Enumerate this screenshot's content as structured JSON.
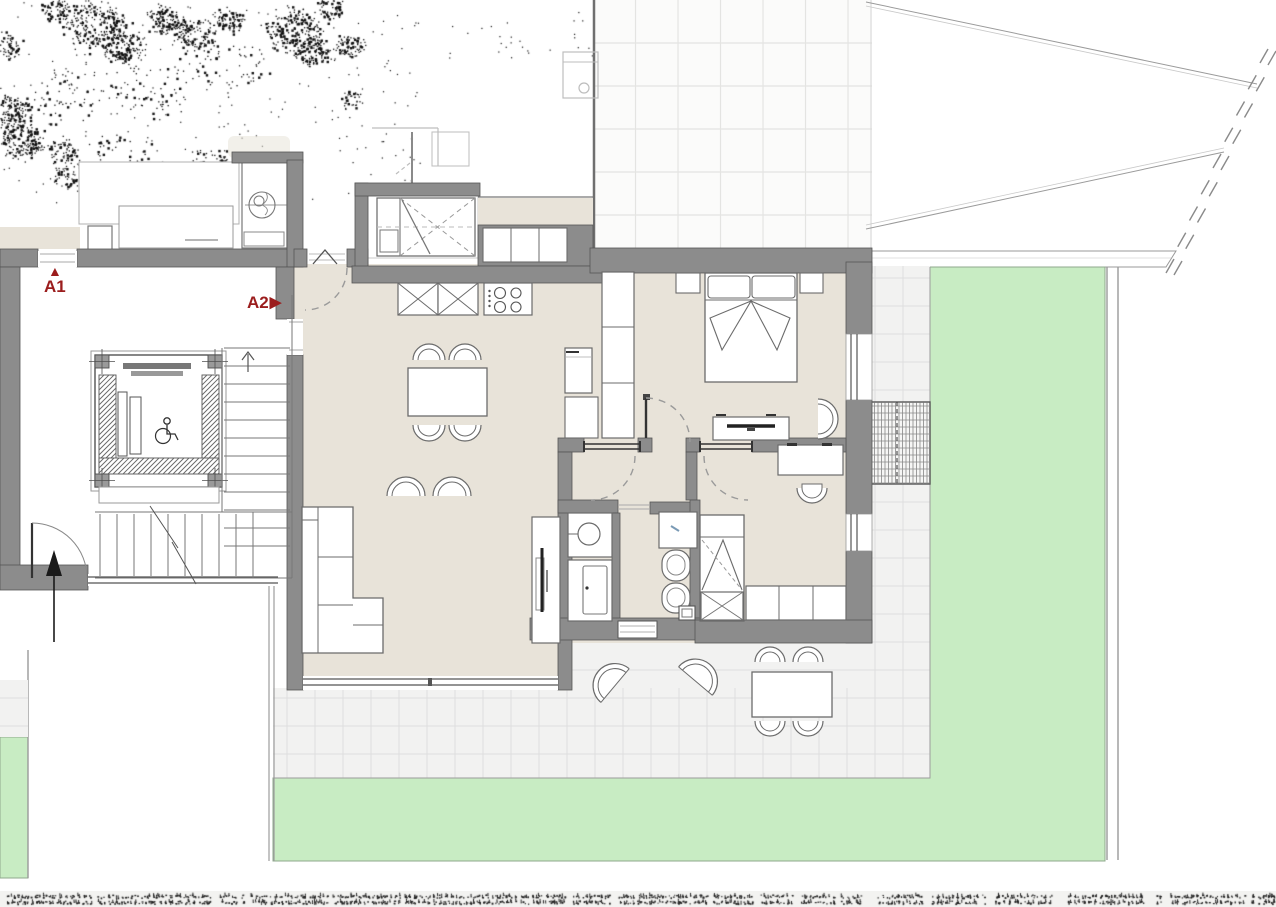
{
  "labels": {
    "a1": {
      "text": "A1",
      "symbol": "▲"
    },
    "a2": {
      "text": "A2",
      "symbol": "▶"
    }
  },
  "palette": {
    "wall": "#8c8c8c",
    "wall_outline": "#555555",
    "floor": "#e8e3d9",
    "garden": "#c8ecc3",
    "garden_edge": "#8fa98c",
    "terrace_tile": "#f2f2f1",
    "terrace_grout": "#dedede",
    "roof_tile": "#fbfbfa",
    "roof_grout": "#e4e4e2",
    "label_red": "#9b1d1d",
    "line": "#6e6e6e",
    "furniture_stroke": "#6b6b6b",
    "dash": "#9a9a9a",
    "ghost": "#bdbdbd",
    "tap_accent": "#7a9ab5",
    "noise_bg": "#f3f3f1",
    "noise_dot": "#1f1f1f",
    "arrow_black": "#1a1a1a"
  },
  "fixtures": [
    "double-bed",
    "nightstand",
    "wardrobe",
    "tv-console",
    "armchair",
    "desk",
    "desk-chair",
    "single-bed",
    "storage-chest",
    "dining-table",
    "dining-chair",
    "sofa",
    "tv-cabinet",
    "kitchen-base-cabinet",
    "cooktop",
    "refrigerator",
    "washbasin",
    "shower",
    "bathroom-sink",
    "toilet",
    "bidet",
    "outdoor-table",
    "outdoor-chair",
    "lounge-chair",
    "elevator",
    "wheelchair-access-symbol",
    "staircase",
    "entrance-arrow",
    "door-swing",
    "sliding-door",
    "pergola-grid",
    "garden",
    "terrace-paving",
    "site-boundary"
  ]
}
